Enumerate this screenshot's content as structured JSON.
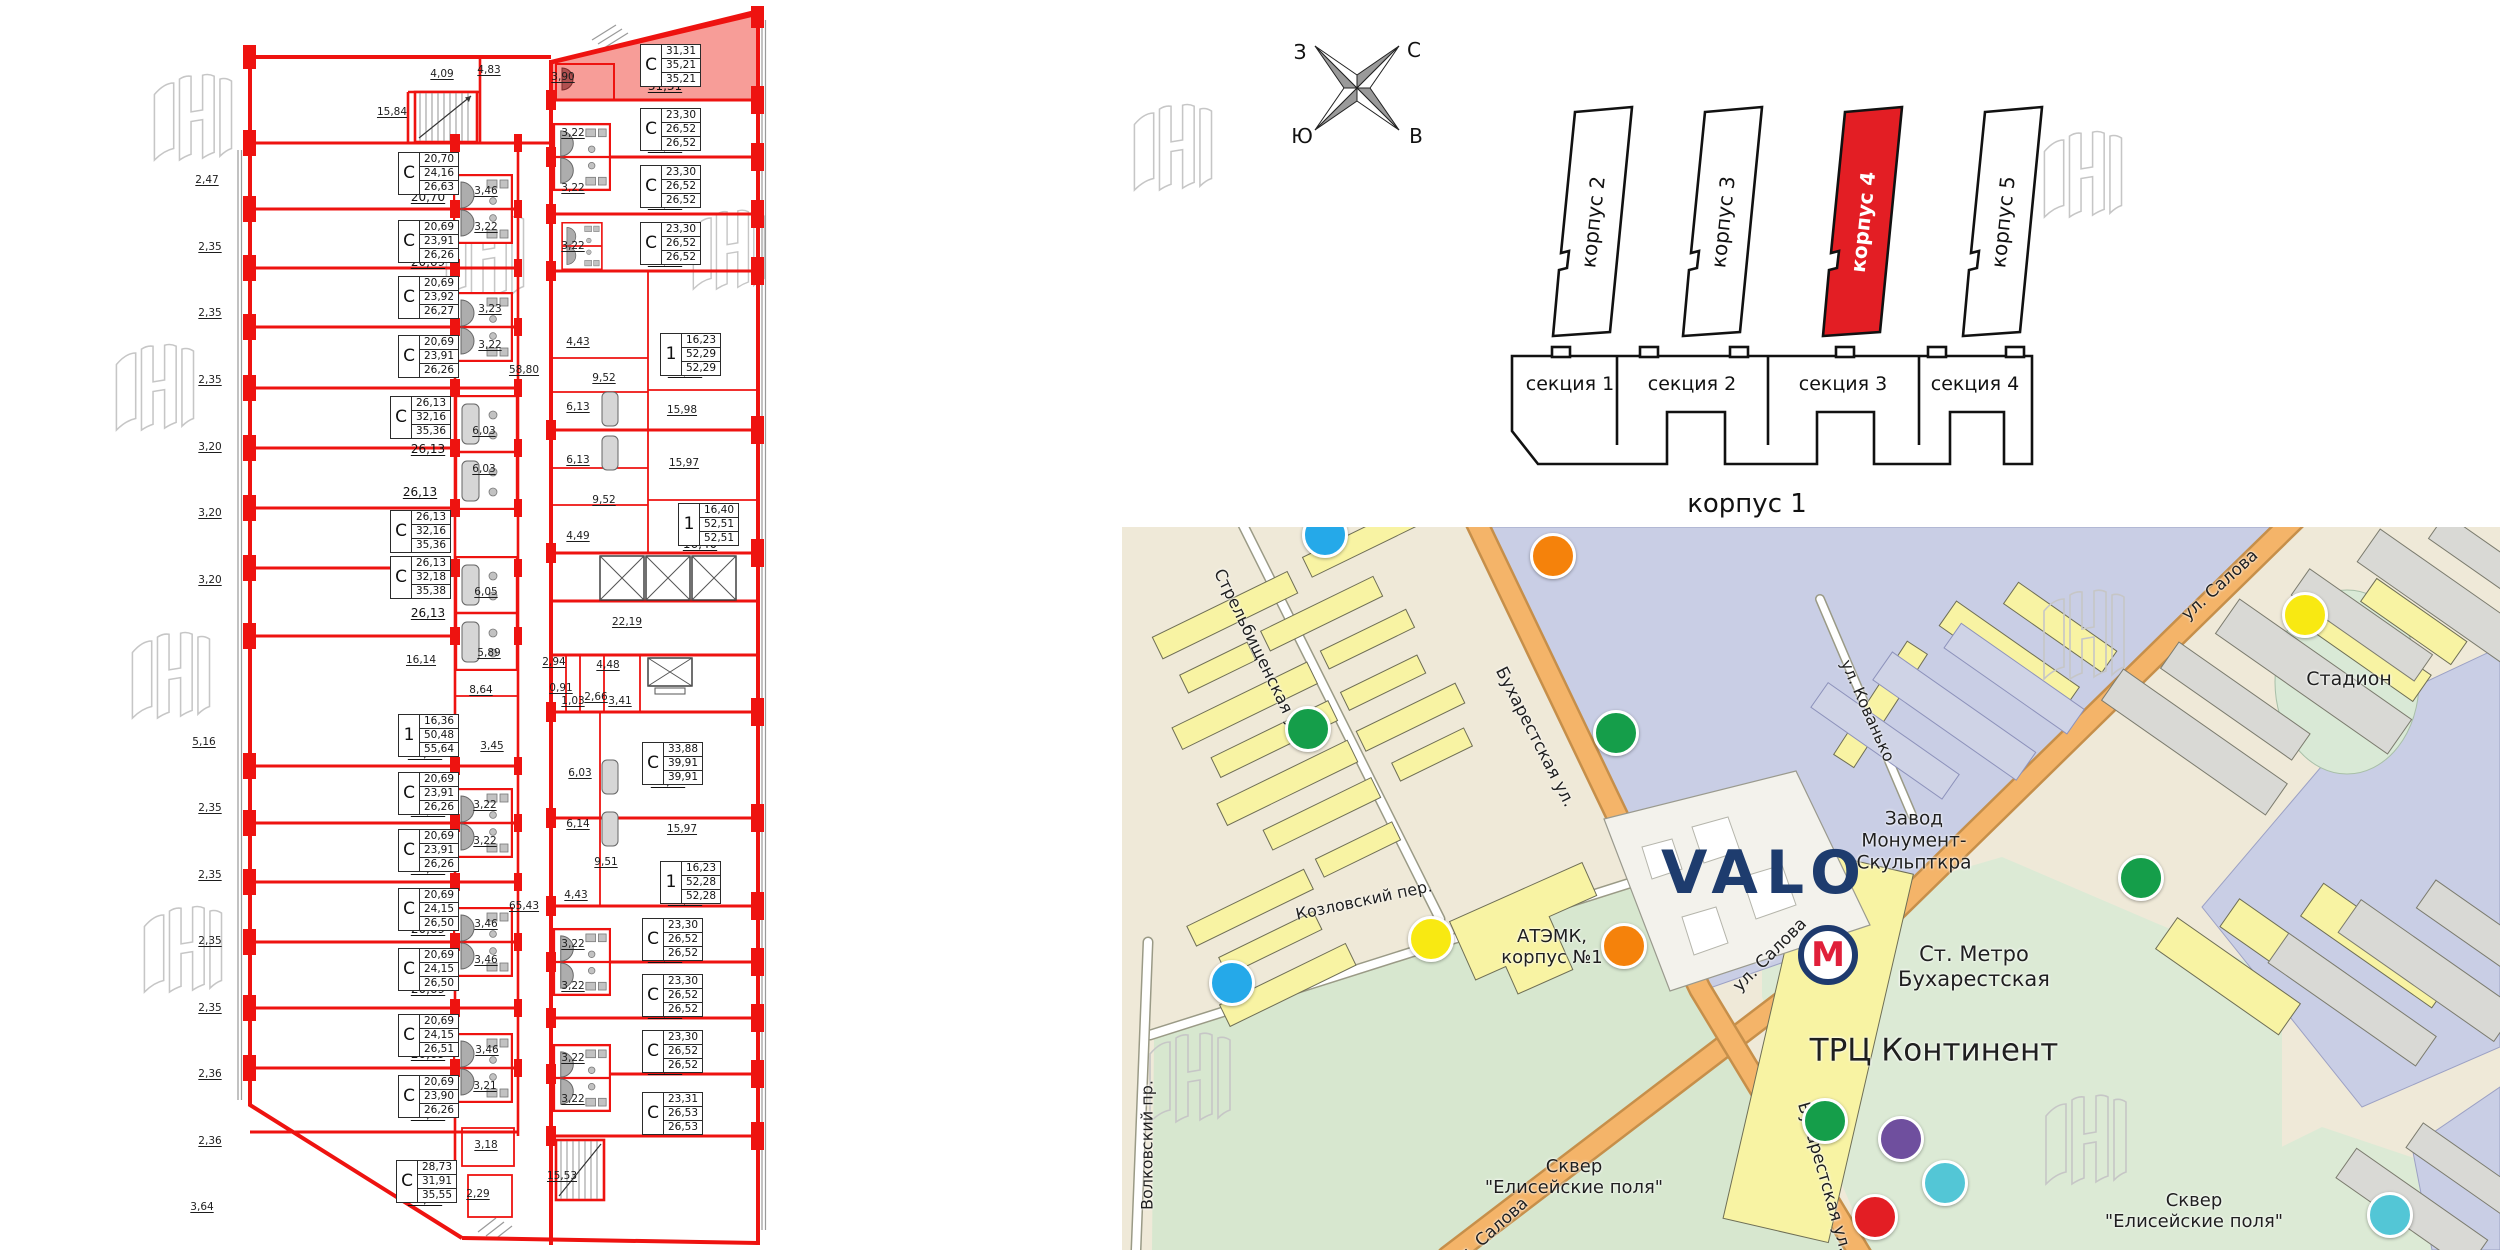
{
  "compass": {
    "west": "З",
    "north": "С",
    "south": "Ю",
    "east": "В"
  },
  "site": {
    "towers": [
      {
        "label": "корпус 2",
        "highlighted": false
      },
      {
        "label": "корпус 3",
        "highlighted": false
      },
      {
        "label": "корпус 4",
        "highlighted": true
      },
      {
        "label": "корпус 5",
        "highlighted": false
      }
    ],
    "sections": [
      "секция 1",
      "секция 2",
      "секция 3",
      "секция 4"
    ],
    "building1_label": "корпус 1",
    "highlight_color": "#e31e24"
  },
  "plan": {
    "highlight_color": "#f79d98",
    "wall_color": "#ee1310",
    "units": [
      {
        "type": "С",
        "v1": "20,70",
        "v2": "24,16",
        "v3": "26,63",
        "room": "20,70",
        "box": [
          398,
          152
        ],
        "rpos": [
          428,
          197
        ],
        "highlighted": false
      },
      {
        "type": "С",
        "v1": "20,69",
        "v2": "23,91",
        "v3": "26,26",
        "room": "20,69",
        "box": [
          398,
          220
        ],
        "rpos": [
          428,
          262
        ],
        "highlighted": false
      },
      {
        "type": "С",
        "v1": "20,69",
        "v2": "23,92",
        "v3": "26,27",
        "room": "20,69",
        "box": [
          398,
          276
        ],
        "rpos": [
          428,
          310
        ],
        "highlighted": false
      },
      {
        "type": "С",
        "v1": "20,69",
        "v2": "23,91",
        "v3": "26,26",
        "room": "20,69",
        "box": [
          398,
          335
        ],
        "rpos": [
          428,
          371
        ],
        "highlighted": false
      },
      {
        "type": "С",
        "v1": "26,13",
        "v2": "32,16",
        "v3": "35,36",
        "room": "26,13",
        "box": [
          390,
          396
        ],
        "rpos": [
          428,
          449
        ],
        "highlighted": false
      },
      {
        "type": "С",
        "v1": "26,13",
        "v2": "32,16",
        "v3": "35,36",
        "room": "26,13",
        "box": [
          390,
          510
        ],
        "rpos": [
          420,
          492
        ],
        "highlighted": false
      },
      {
        "type": "С",
        "v1": "26,13",
        "v2": "32,18",
        "v3": "35,38",
        "room": "26,13",
        "box": [
          390,
          556
        ],
        "rpos": [
          428,
          613
        ],
        "highlighted": false
      },
      {
        "type": "1",
        "v1": "16,36",
        "v2": "50,48",
        "v3": "55,64",
        "room": "16,36",
        "box": [
          398,
          714
        ],
        "rpos": [
          425,
          753
        ],
        "highlighted": false
      },
      {
        "type": "С",
        "v1": "20,69",
        "v2": "23,91",
        "v3": "26,26",
        "room": "20,69",
        "box": [
          398,
          772
        ],
        "rpos": [
          428,
          810
        ],
        "highlighted": false
      },
      {
        "type": "С",
        "v1": "20,69",
        "v2": "23,91",
        "v3": "26,26",
        "room": "20,69",
        "box": [
          398,
          829
        ],
        "rpos": [
          428,
          868
        ],
        "highlighted": false
      },
      {
        "type": "С",
        "v1": "20,69",
        "v2": "24,15",
        "v3": "26,50",
        "room": "20,69",
        "box": [
          398,
          888
        ],
        "rpos": [
          428,
          929
        ],
        "highlighted": false
      },
      {
        "type": "С",
        "v1": "20,69",
        "v2": "24,15",
        "v3": "26,50",
        "room": "20,69",
        "box": [
          398,
          948
        ],
        "rpos": [
          428,
          989
        ],
        "highlighted": false
      },
      {
        "type": "С",
        "v1": "20,69",
        "v2": "24,15",
        "v3": "26,51",
        "room": "20,69",
        "box": [
          398,
          1014
        ],
        "rpos": [
          428,
          1054
        ],
        "highlighted": false
      },
      {
        "type": "С",
        "v1": "20,69",
        "v2": "23,90",
        "v3": "26,26",
        "room": "20,69",
        "box": [
          398,
          1075
        ],
        "rpos": [
          428,
          1114
        ],
        "highlighted": false
      },
      {
        "type": "С",
        "v1": "28,73",
        "v2": "31,91",
        "v3": "35,55",
        "room": "28,73",
        "box": [
          396,
          1160
        ],
        "rpos": [
          425,
          1199
        ],
        "highlighted": false
      },
      {
        "type": "С",
        "v1": "31,31",
        "v2": "35,21",
        "v3": "35,21",
        "room": "31,31",
        "box": [
          640,
          44
        ],
        "rpos": [
          665,
          86
        ],
        "highlighted": true
      },
      {
        "type": "С",
        "v1": "23,30",
        "v2": "26,52",
        "v3": "26,52",
        "room": "23,30",
        "box": [
          640,
          108
        ],
        "rpos": [
          665,
          146
        ],
        "highlighted": false
      },
      {
        "type": "С",
        "v1": "23,30",
        "v2": "26,52",
        "v3": "26,52",
        "room": "23,30",
        "box": [
          640,
          165
        ],
        "rpos": [
          665,
          203
        ],
        "highlighted": false
      },
      {
        "type": "С",
        "v1": "23,30",
        "v2": "26,52",
        "v3": "26,52",
        "room": "23,30",
        "box": [
          640,
          222
        ],
        "rpos": [
          665,
          260
        ],
        "highlighted": false
      },
      {
        "type": "1",
        "v1": "16,23",
        "v2": "52,29",
        "v3": "52,29",
        "room": "16,23",
        "box": [
          660,
          333
        ],
        "rpos": [
          685,
          371
        ],
        "highlighted": false
      },
      {
        "type": "1",
        "v1": "16,40",
        "v2": "52,51",
        "v3": "52,51",
        "room": "16,40",
        "box": [
          678,
          503
        ],
        "rpos": [
          700,
          544
        ],
        "highlighted": false
      },
      {
        "type": "С",
        "v1": "33,88",
        "v2": "39,91",
        "v3": "39,91",
        "room": "33,88",
        "box": [
          642,
          742
        ],
        "rpos": [
          668,
          781
        ],
        "highlighted": false
      },
      {
        "type": "1",
        "v1": "16,23",
        "v2": "52,28",
        "v3": "52,28",
        "room": "16,23",
        "box": [
          660,
          861
        ],
        "rpos": [
          685,
          899
        ],
        "highlighted": false
      },
      {
        "type": "С",
        "v1": "23,30",
        "v2": "26,52",
        "v3": "26,52",
        "room": "23,30",
        "box": [
          642,
          918
        ],
        "rpos": [
          665,
          956
        ],
        "highlighted": false
      },
      {
        "type": "С",
        "v1": "23,30",
        "v2": "26,52",
        "v3": "26,52",
        "room": "23,30",
        "box": [
          642,
          974
        ],
        "rpos": [
          665,
          1012
        ],
        "highlighted": false
      },
      {
        "type": "С",
        "v1": "23,30",
        "v2": "26,52",
        "v3": "26,52",
        "room": "23,30",
        "box": [
          642,
          1030
        ],
        "rpos": [
          665,
          1068
        ],
        "highlighted": false
      },
      {
        "type": "С",
        "v1": "23,31",
        "v2": "26,53",
        "v3": "26,53",
        "room": "23,31",
        "box": [
          642,
          1092
        ],
        "rpos": [
          663,
          1126
        ],
        "highlighted": false
      }
    ],
    "dims": [
      {
        "t": "2,47",
        "x": 207,
        "y": 180
      },
      {
        "t": "2,35",
        "x": 210,
        "y": 247
      },
      {
        "t": "2,35",
        "x": 210,
        "y": 313
      },
      {
        "t": "2,35",
        "x": 210,
        "y": 380
      },
      {
        "t": "3,20",
        "x": 210,
        "y": 447
      },
      {
        "t": "3,20",
        "x": 210,
        "y": 513
      },
      {
        "t": "3,20",
        "x": 210,
        "y": 580
      },
      {
        "t": "5,16",
        "x": 204,
        "y": 742
      },
      {
        "t": "2,35",
        "x": 210,
        "y": 808
      },
      {
        "t": "2,35",
        "x": 210,
        "y": 875
      },
      {
        "t": "2,35",
        "x": 210,
        "y": 941
      },
      {
        "t": "2,35",
        "x": 210,
        "y": 1008
      },
      {
        "t": "2,36",
        "x": 210,
        "y": 1074
      },
      {
        "t": "2,36",
        "x": 210,
        "y": 1141
      },
      {
        "t": "3,64",
        "x": 202,
        "y": 1207
      },
      {
        "t": "4,09",
        "x": 442,
        "y": 74
      },
      {
        "t": "4,83",
        "x": 489,
        "y": 70
      },
      {
        "t": "15,84",
        "x": 392,
        "y": 112
      },
      {
        "t": "58,80",
        "x": 524,
        "y": 370
      },
      {
        "t": "65,43",
        "x": 524,
        "y": 906
      },
      {
        "t": "22,19",
        "x": 627,
        "y": 622
      },
      {
        "t": "2,94",
        "x": 554,
        "y": 662
      },
      {
        "t": "4,48",
        "x": 608,
        "y": 665
      },
      {
        "t": "0,91",
        "x": 561,
        "y": 688
      },
      {
        "t": "1,03",
        "x": 573,
        "y": 701
      },
      {
        "t": "2,66",
        "x": 596,
        "y": 697
      },
      {
        "t": "3,41",
        "x": 620,
        "y": 701
      },
      {
        "t": "3,90",
        "x": 563,
        "y": 77
      },
      {
        "t": "3,22",
        "x": 573,
        "y": 133
      },
      {
        "t": "3,22",
        "x": 573,
        "y": 188
      },
      {
        "t": "3,22",
        "x": 573,
        "y": 246
      },
      {
        "t": "4,43",
        "x": 578,
        "y": 342
      },
      {
        "t": "9,52",
        "x": 604,
        "y": 378
      },
      {
        "t": "6,13",
        "x": 578,
        "y": 407
      },
      {
        "t": "15,98",
        "x": 682,
        "y": 410
      },
      {
        "t": "6,13",
        "x": 578,
        "y": 460
      },
      {
        "t": "15,97",
        "x": 684,
        "y": 463
      },
      {
        "t": "9,52",
        "x": 604,
        "y": 500
      },
      {
        "t": "4,49",
        "x": 578,
        "y": 536
      },
      {
        "t": "6,03",
        "x": 580,
        "y": 773
      },
      {
        "t": "6,14",
        "x": 578,
        "y": 824
      },
      {
        "t": "9,51",
        "x": 606,
        "y": 862
      },
      {
        "t": "4,43",
        "x": 576,
        "y": 895
      },
      {
        "t": "15,97",
        "x": 682,
        "y": 829
      },
      {
        "t": "3,22",
        "x": 573,
        "y": 944
      },
      {
        "t": "3,22",
        "x": 573,
        "y": 986
      },
      {
        "t": "3,22",
        "x": 573,
        "y": 1058
      },
      {
        "t": "3,22",
        "x": 573,
        "y": 1099
      },
      {
        "t": "15,53",
        "x": 562,
        "y": 1176
      },
      {
        "t": "2,29",
        "x": 478,
        "y": 1194
      },
      {
        "t": "3,18",
        "x": 486,
        "y": 1145
      },
      {
        "t": "3,46",
        "x": 486,
        "y": 191
      },
      {
        "t": "3,22",
        "x": 486,
        "y": 227
      },
      {
        "t": "3,23",
        "x": 490,
        "y": 309
      },
      {
        "t": "3,22",
        "x": 490,
        "y": 345
      },
      {
        "t": "6,03",
        "x": 484,
        "y": 431
      },
      {
        "t": "6,03",
        "x": 484,
        "y": 469
      },
      {
        "t": "6,05",
        "x": 486,
        "y": 592
      },
      {
        "t": "5,89",
        "x": 489,
        "y": 653
      },
      {
        "t": "16,14",
        "x": 421,
        "y": 660
      },
      {
        "t": "8,64",
        "x": 481,
        "y": 690
      },
      {
        "t": "3,45",
        "x": 492,
        "y": 746
      },
      {
        "t": "3,22",
        "x": 485,
        "y": 805
      },
      {
        "t": "3,22",
        "x": 485,
        "y": 841
      },
      {
        "t": "3,46",
        "x": 486,
        "y": 924
      },
      {
        "t": "3,46",
        "x": 486,
        "y": 960
      },
      {
        "t": "3,46",
        "x": 487,
        "y": 1050
      },
      {
        "t": "3,21",
        "x": 485,
        "y": 1086
      }
    ]
  },
  "map": {
    "logo": "VALO",
    "metro": {
      "letter": "М",
      "name": "Ст. Метро\nБухарестская"
    },
    "labels": [
      {
        "t": "Стрельбищенская ул.",
        "x": 138,
        "y": 128,
        "r": 64,
        "s": 16.5
      },
      {
        "t": "Бухарестская ул.",
        "x": 413,
        "y": 210,
        "r": 63,
        "s": 17
      },
      {
        "t": "Бухарестская ул.",
        "x": 702,
        "y": 650,
        "r": 74,
        "s": 17
      },
      {
        "t": "ул. Салова",
        "x": 1098,
        "y": 58,
        "r": -42,
        "s": 17
      },
      {
        "t": "ул. Салова",
        "x": 648,
        "y": 428,
        "r": -45,
        "s": 17
      },
      {
        "t": "ул. Салова",
        "x": 368,
        "y": 706,
        "r": -42,
        "s": 17
      },
      {
        "t": "ул. Кованько",
        "x": 745,
        "y": 184,
        "r": 66,
        "s": 16
      },
      {
        "t": "Козловский пер.",
        "x": 242,
        "y": 374,
        "r": -12,
        "s": 16
      },
      {
        "t": "Волковский пр.",
        "x": 26,
        "y": 618,
        "r": -90,
        "s": 16
      },
      {
        "t": "Завод\nМонумент-\nСкульпткра",
        "x": 792,
        "y": 314,
        "r": 0,
        "s": 18.5
      },
      {
        "t": "Стадион",
        "x": 1227,
        "y": 152,
        "r": 0,
        "s": 19
      },
      {
        "t": "АТЭМК,\nкорпус №1",
        "x": 430,
        "y": 420,
        "r": 0,
        "s": 18
      },
      {
        "t": "Ст. Метро\nБухарестская",
        "x": 852,
        "y": 440,
        "r": 0,
        "s": 21
      },
      {
        "t": "ТРЦ Континент",
        "x": 812,
        "y": 524,
        "r": 0,
        "s": 31
      },
      {
        "t": "Сквер\n\"Елисейские поля\"",
        "x": 452,
        "y": 650,
        "r": 0,
        "s": 18
      },
      {
        "t": "Сквер\n\"Елисейские поля\"",
        "x": 1072,
        "y": 684,
        "r": 0,
        "s": 18
      }
    ],
    "markers": [
      {
        "x": 431,
        "y": 29,
        "c": "#f5820b"
      },
      {
        "x": 203,
        "y": 8,
        "c": "#25a9e9"
      },
      {
        "x": 186,
        "y": 202,
        "c": "#159e4a"
      },
      {
        "x": 494,
        "y": 206,
        "c": "#159e4a"
      },
      {
        "x": 110,
        "y": 456,
        "c": "#25a9e9"
      },
      {
        "x": 309,
        "y": 412,
        "c": "#f8e912"
      },
      {
        "x": 502,
        "y": 419,
        "c": "#f5820b"
      },
      {
        "x": 1183,
        "y": 88,
        "c": "#f8e912"
      },
      {
        "x": 1019,
        "y": 351,
        "c": "#159e4a"
      },
      {
        "x": 703,
        "y": 594,
        "c": "#159e4a"
      },
      {
        "x": 779,
        "y": 612,
        "c": "#6f4f9e"
      },
      {
        "x": 823,
        "y": 656,
        "c": "#53c6d6"
      },
      {
        "x": 753,
        "y": 690,
        "c": "#e31e24"
      },
      {
        "x": 1268,
        "y": 688,
        "c": "#53c6d6"
      }
    ]
  }
}
